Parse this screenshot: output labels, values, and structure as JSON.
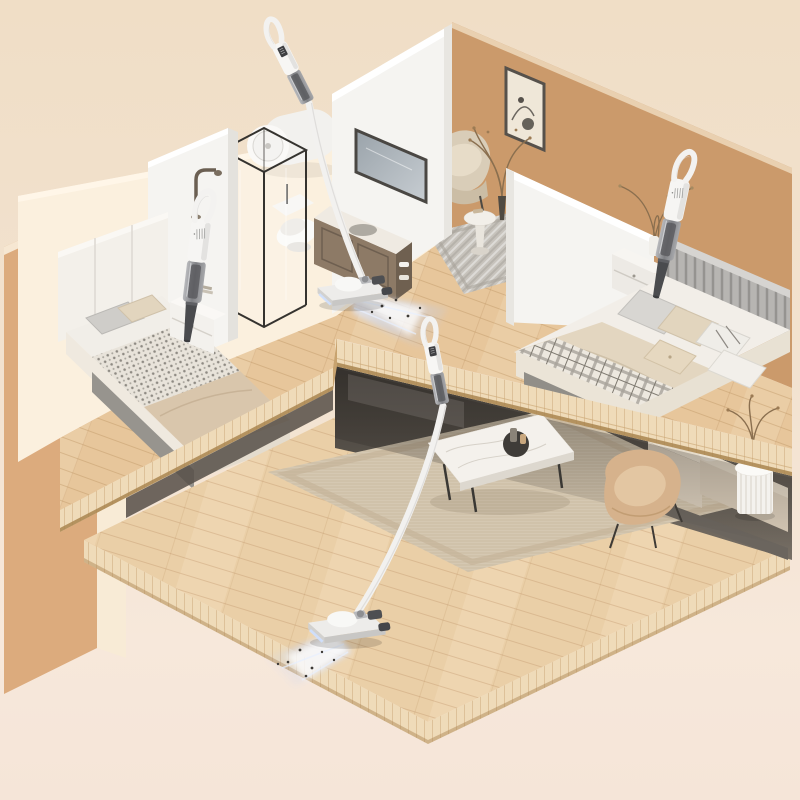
{
  "image": {
    "type": "product-lifestyle-render",
    "subject": "Cordless stick and handheld vacuum cleaners cleaning a two-storey isometric dollhouse-style home cutaway",
    "background": "plain warm beige studio backdrop, no text"
  },
  "colors": {
    "backdrop_top": "#F0DEC6",
    "backdrop_bottom": "#F7E8DB",
    "wall_tan": "#CB9A6B",
    "wall_tan_light": "#DCAB7D",
    "wall_cream": "#FBF0DE",
    "wall_white": "#F5F4F1",
    "wood_upper": "#E7C69B",
    "wood_lower": "#EACFA7",
    "wood_edge": "#EFDBB9",
    "under_shadow": "#3C3833",
    "rug_living": "#D5C8B2",
    "rug_nook": "#C7C3BC",
    "sofa": "#D7CAB7",
    "armchair_tan": "#D6B28C",
    "coffee_table_marble": "#F4F1EC",
    "bedding_white": "#F2EEE8",
    "blanket_beige": "#D9C6AC",
    "vacuum_white": "#F6F5F3",
    "vacuum_gray_cup": "#8E8F92",
    "vacuum_dark": "#4A4B4E",
    "suction_glow": "#C9D9F9"
  },
  "rooms": [
    {
      "name": "bedroom-left",
      "level": "upper",
      "items": [
        "double bed with white panelled headboard",
        "houndstooth blanket",
        "grey and beige pillows",
        "white nightstand with teddy bear and books",
        "handheld vacuum cleaning the mattress"
      ]
    },
    {
      "name": "bathroom",
      "level": "upper",
      "items": [
        "black-framed glass shower cabin",
        "white toilet",
        "wall-mounted cylindrical water heater",
        "gooseneck shower faucet",
        "vanity cabinet with marble top",
        "wall mirror"
      ]
    },
    {
      "name": "reading-nook",
      "level": "upper",
      "items": [
        "framed abstract line art",
        "beige armchair",
        "small round side table",
        "dried-branch plant in dark vase",
        "grey patterned rug"
      ]
    },
    {
      "name": "bedroom-right",
      "level": "upper",
      "items": [
        "double bed with grey slatted headboard",
        "plaid throw over beige duvet",
        "assorted pillows",
        "white nightstand",
        "dried-branch vase",
        "handheld vacuum cleaning the mattress"
      ]
    },
    {
      "name": "living-room",
      "level": "lower",
      "items": [
        "large beige woven rug",
        "marble coffee table with round black inset",
        "beige sofa tucked under the mezzanine",
        "tan lounge chair",
        "white fluted side table with dried plant",
        "stick vacuum cleaning the floor"
      ]
    }
  ],
  "vacuums": [
    {
      "id": "handheld-left",
      "type": "handheld",
      "state": "nozzle touching left bed"
    },
    {
      "id": "stick-upper",
      "type": "stick",
      "state": "standing on upper floor, blue suction glow with dust particles"
    },
    {
      "id": "handheld-right",
      "type": "handheld",
      "state": "nozzle touching right bed"
    },
    {
      "id": "stick-lower",
      "type": "stick",
      "state": "standing on living-room floor, blue suction glow with dust particles"
    }
  ]
}
